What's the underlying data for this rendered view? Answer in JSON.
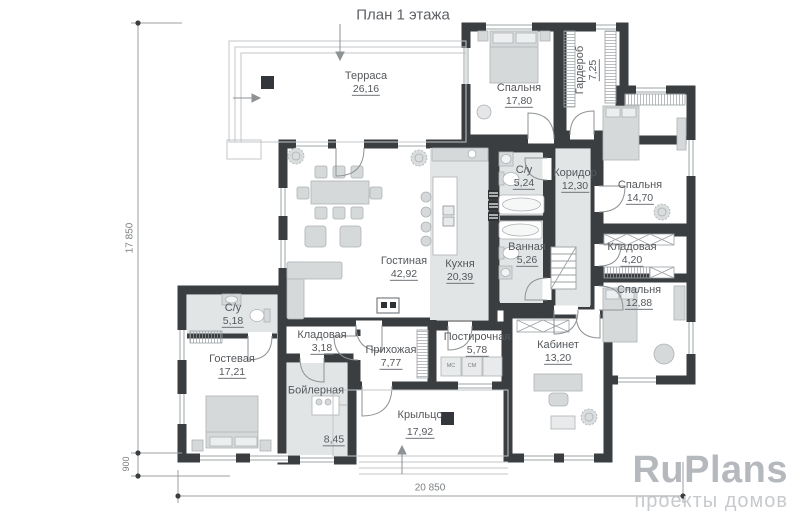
{
  "title": "План 1 этажа",
  "rooms": [
    {
      "name": "Терраса",
      "area": "26,16"
    },
    {
      "name": "Спальня",
      "area": "17,80"
    },
    {
      "name": "Гардероб",
      "area": "7,25"
    },
    {
      "name": "Коридор",
      "area": "12,30"
    },
    {
      "name": "Спальня",
      "area": "14,70"
    },
    {
      "name": "С/у",
      "area": "5,24"
    },
    {
      "name": "Ванная",
      "area": "5,26"
    },
    {
      "name": "Кладовая",
      "area": "4,20"
    },
    {
      "name": "Спальня",
      "area": "12,88"
    },
    {
      "name": "Гостиная",
      "area": "42,92"
    },
    {
      "name": "Кухня",
      "area": "20,39"
    },
    {
      "name": "С/у",
      "area": "5,18"
    },
    {
      "name": "Кладовая",
      "area": "3,18"
    },
    {
      "name": "Прихожая",
      "area": "7,77"
    },
    {
      "name": "Постирочная",
      "area": "5,78"
    },
    {
      "name": "Кабинет",
      "area": "13,20"
    },
    {
      "name": "Гостевая",
      "area": "17,21"
    },
    {
      "name": "Бойлерная",
      "area": "8,45"
    },
    {
      "name": "Крыльцо",
      "area": "17,92"
    }
  ],
  "dimensions": {
    "height_total": "17 850",
    "porch_offset": "900",
    "width_total": "20 850"
  },
  "laundry_appliances": {
    "left": "МС",
    "right": "СМ"
  },
  "watermark": {
    "brand": "RuPlans",
    "tagline": "проекты домов"
  },
  "colors": {
    "wall": "#3b3e41",
    "floor_gray": "#e2e5e6",
    "furniture": "#d6d9da",
    "thin_line": "#9aa0a3",
    "label_text": "#54585c",
    "dim_text": "#7c8083",
    "watermark_brand": "#b5b9be",
    "watermark_tagline": "#c7cacd"
  }
}
